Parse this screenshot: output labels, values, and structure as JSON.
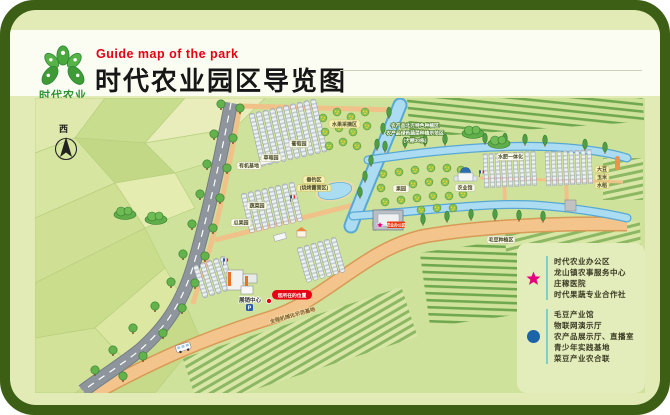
{
  "header": {
    "logo_name": "时代农业",
    "logo_sub": "TIME AGRICULTURE",
    "subtitle_en": "Guide map of the park",
    "title": "时代农业园区导览图"
  },
  "map": {
    "compass": "西",
    "labels": {
      "orchard_pick": "水果采摘区",
      "info_line1": "农产品北方特色种植区",
      "info_line2": "农产品绿色蔬菜种植示范区",
      "info_line3": "(大棚30栋)",
      "grape": "葡萄园",
      "strawberry": "草莓园",
      "organic_base": "有机基地",
      "fishing": "垂钓区",
      "fishing_sub": "(烧烤露营区)",
      "vegetable": "蔬菜园",
      "melon": "瓜果园",
      "water_fert": "水肥一体化",
      "orchard": "果园",
      "agri_hall": "农业馆",
      "office_sign": "农业办公区",
      "soybean_area": "毛豆种植区",
      "exhibition_center": "展销中心",
      "you_are_here": "您所在的位置",
      "mech_road": "全程机械化示范基地",
      "parking": "P",
      "crop_tag1": "大豆",
      "crop_tag2": "玉米",
      "crop_tag3": "水稻"
    }
  },
  "legend": {
    "star_color": "#e4007f",
    "dot_color": "#1c63a8",
    "star_items": [
      "时代农业办公区",
      "龙山镇农事服务中心",
      "庄稼医院",
      "时代果蔬专业合作社"
    ],
    "dot_items": [
      "毛豆产业馆",
      "物联网演示厅",
      "农产品展示厅、直播室",
      "青少年实践基地",
      "菜豆产业农合联"
    ]
  },
  "colors": {
    "frame": "#3d5f15",
    "accent_red": "#e60012",
    "logo_green": "#2f9335"
  }
}
